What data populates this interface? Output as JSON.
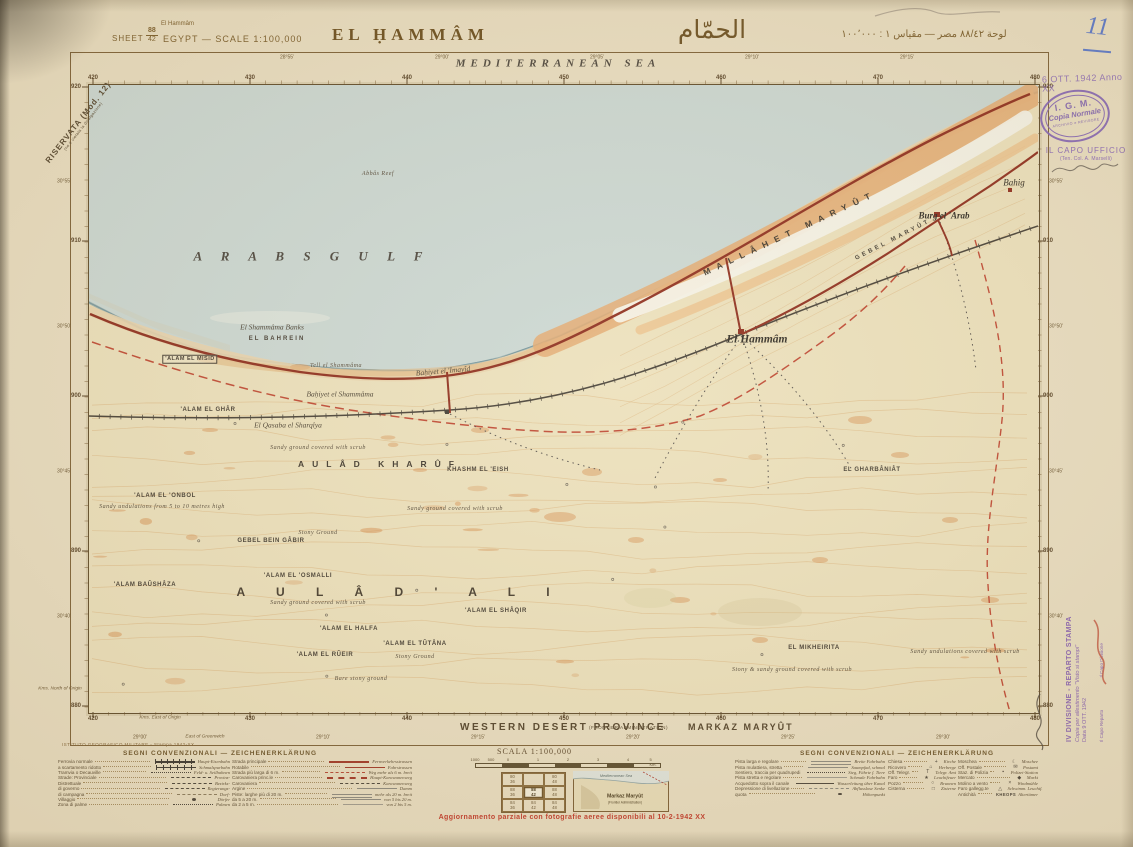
{
  "header": {
    "restricted": "RISERVATA (Mod. 12)",
    "restricted_sub": "(ne è vietata la divulgazione)",
    "sheet_label": "SHEET",
    "sheet_num_top": "88",
    "sheet_num_bottom": "42",
    "place_small": "El Hammâm",
    "country_scale": "EGYPT — SCALE 1:100,000",
    "title": "EL ḤAMMÂM",
    "title_arabic": "الحمّام",
    "arabic_scale": "لوحة ٨٨/٤٢   مصر — مقياس ١ : ١٠٠٬٠٠٠",
    "handwritten_number": "11",
    "date_stamp": "6 OTT. 1942 Anno XX"
  },
  "stamps": {
    "igm_line1": "I. G. M.",
    "igm_line2": "Copia Normale",
    "igm_line3": "ARCHIVIO e REVISORE",
    "capo_line1": "IL CAPO UFFICIO",
    "capo_line2": "(Ten. Col. A. Marselli)",
    "side_line1": "IV DIVISIONE - REPARTO STAMPA",
    "side_line2": "Copia per allestimento \"Visto si stampi\"",
    "side_line3": "Data  9 OTT. 1942",
    "side_line4": "Il Capo Reparto",
    "side_line5": "Il Capo Divisione"
  },
  "map": {
    "labels": [
      {
        "t": "MEDITERRANEAN  SEA",
        "x": 558,
        "y": 64,
        "c": "sea",
        "ls": 5
      },
      {
        "t": "A R A B S      G U L F",
        "x": 312,
        "y": 256,
        "c": "gulf",
        "ls": 8
      },
      {
        "t": "Abbâs Reef",
        "x": 378,
        "y": 174,
        "c": "nxx"
      },
      {
        "t": "El Shammâma Banks",
        "x": 272,
        "y": 327,
        "c": "nit"
      },
      {
        "t": "EL BAHREIN",
        "x": 277,
        "y": 339,
        "c": "cxs",
        "ls": 2
      },
      {
        "t": "'ALAM EL MISID",
        "x": 190,
        "y": 359,
        "c": "cbox"
      },
      {
        "t": "Tell el Shammâma",
        "x": 336,
        "y": 366,
        "c": "nxx"
      },
      {
        "t": "Baḥiyet el 'Imayîd",
        "x": 443,
        "y": 371,
        "c": "nit",
        "r": -5
      },
      {
        "t": "Baḥiyet el Shammâma",
        "x": 340,
        "y": 394,
        "c": "nit"
      },
      {
        "t": "'ALAM EL GHÂR",
        "x": 208,
        "y": 410,
        "c": "cxs"
      },
      {
        "t": "El Qasaba el Sharqîya",
        "x": 288,
        "y": 425,
        "c": "nit"
      },
      {
        "t": "Sandy ground covered with scrub",
        "x": 318,
        "y": 448,
        "c": "nxx"
      },
      {
        "t": "AULÂD  KHARÛF",
        "x": 380,
        "y": 464,
        "c": "cmd",
        "ls": 8
      },
      {
        "t": "KHASHM EL 'EISH",
        "x": 478,
        "y": 470,
        "c": "cxs"
      },
      {
        "t": "'ALAM EL 'ONBOL",
        "x": 165,
        "y": 496,
        "c": "cxs"
      },
      {
        "t": "Sandy undulations from 5 to 10 metres high",
        "x": 162,
        "y": 507,
        "c": "nxx"
      },
      {
        "t": "Sandy ground covered with scrub",
        "x": 455,
        "y": 509,
        "c": "nxx"
      },
      {
        "t": "Stony Ground",
        "x": 318,
        "y": 533,
        "c": "nxx"
      },
      {
        "t": "GEBEL BEIN GÂBIR",
        "x": 271,
        "y": 541,
        "c": "cxs"
      },
      {
        "t": "'ALAM EL 'OSMALLI",
        "x": 298,
        "y": 576,
        "c": "cxs"
      },
      {
        "t": "'ALAM BAÛSHÂZA",
        "x": 145,
        "y": 585,
        "c": "cxs"
      },
      {
        "t": "A U L Â D    ' A L I",
        "x": 400,
        "y": 592,
        "c": "clg",
        "ls": 14
      },
      {
        "t": "Sandy ground covered with scrub",
        "x": 318,
        "y": 603,
        "c": "nxx"
      },
      {
        "t": "'ALAM EL SHÂQIR",
        "x": 496,
        "y": 611,
        "c": "cxs"
      },
      {
        "t": "'ALAM EL HALFA",
        "x": 349,
        "y": 629,
        "c": "cxs"
      },
      {
        "t": "'ALAM EL TÛTÂNA",
        "x": 415,
        "y": 644,
        "c": "cxs"
      },
      {
        "t": "'ALAM EL RÛEIR",
        "x": 325,
        "y": 655,
        "c": "cxs"
      },
      {
        "t": "Stony Ground",
        "x": 415,
        "y": 657,
        "c": "nxx"
      },
      {
        "t": "Bare stony ground",
        "x": 361,
        "y": 679,
        "c": "nxx"
      },
      {
        "t": "EL MIKHEIRITA",
        "x": 814,
        "y": 648,
        "c": "cxs"
      },
      {
        "t": "Stony & sandy ground covered with scrub",
        "x": 792,
        "y": 670,
        "c": "nxx"
      },
      {
        "t": "Sandy undulations covered with scrub",
        "x": 965,
        "y": 652,
        "c": "nxx"
      },
      {
        "t": "El Ḥammâm",
        "x": 757,
        "y": 340,
        "c": "town"
      },
      {
        "t": "MALLÂHET  MARYÛT",
        "x": 790,
        "y": 233,
        "c": "cmd",
        "ls": 7,
        "r": -25
      },
      {
        "t": "GEBEL MARYÛT",
        "x": 893,
        "y": 240,
        "c": "cxs",
        "ls": 3,
        "r": -27
      },
      {
        "t": "Burg el 'Arab",
        "x": 944,
        "y": 216,
        "c": "tsm"
      },
      {
        "t": "Bahig",
        "x": 1014,
        "y": 183,
        "c": "tit"
      },
      {
        "t": "EL GHARBÂNIÂT",
        "x": 872,
        "y": 470,
        "c": "cxs"
      }
    ],
    "grid": {
      "eastings": [
        {
          "t": "420",
          "x": 93
        },
        {
          "t": "430",
          "x": 250
        },
        {
          "t": "440",
          "x": 407
        },
        {
          "t": "450",
          "x": 564
        },
        {
          "t": "460",
          "x": 721
        },
        {
          "t": "470",
          "x": 878
        },
        {
          "t": "480",
          "x": 1035
        }
      ],
      "northings": [
        {
          "t": "920",
          "y": 87
        },
        {
          "t": "910",
          "y": 241
        },
        {
          "t": "900",
          "y": 396
        },
        {
          "t": "890",
          "y": 551
        },
        {
          "t": "880",
          "y": 706
        }
      ],
      "top_longitudes": [
        {
          "t": "28°55′",
          "x": 287
        },
        {
          "t": "29°00′",
          "x": 442
        },
        {
          "t": "29°05′",
          "x": 597
        },
        {
          "t": "29°10′",
          "x": 752
        },
        {
          "t": "29°15′",
          "x": 907
        }
      ],
      "bottom_longitudes": [
        {
          "t": "29°00′",
          "x": 140
        },
        {
          "t": "29°10′",
          "x": 323
        },
        {
          "t": "29°15′",
          "x": 478
        },
        {
          "t": "29°20′",
          "x": 633
        },
        {
          "t": "29°25′",
          "x": 788
        },
        {
          "t": "29°30′",
          "x": 943
        }
      ],
      "latitudes": [
        {
          "t": "30°55′",
          "y": 182
        },
        {
          "t": "30°50′",
          "y": 327
        },
        {
          "t": "30°45′",
          "y": 472
        },
        {
          "t": "30°40′",
          "y": 617
        }
      ],
      "greenwich": "East of Greenwich",
      "origin_north": "Kms. North of Origin",
      "origin_east": "Kms. East of Origin"
    }
  },
  "footer": {
    "province": "WESTERN  DESERT  PROVINCE",
    "province_sub": "(FRONTIER ADMINISTRATION)",
    "markaz": "MARKAZ  MARYÛT",
    "imprint": "ISTITUTO GEOGRAFICO MILITARE - Stampa 1942-XX",
    "scale_caption": "SCALA  1:100,000",
    "scale_numbers": [
      "1000",
      "500",
      "0",
      "1",
      "2",
      "3",
      "4",
      "5 Km."
    ],
    "update_note": "Aggiornamento parziale con fotografie aeree disponibili al 10-2-1942 XX",
    "inset": {
      "sea": "Mediterranean Sea",
      "name": "Markaz Maryût",
      "sub": "(Frontier Administration)"
    },
    "index_grid": [
      [
        "80/36",
        "",
        "80/48"
      ],
      [
        "88/36",
        "88/42",
        "88/48"
      ],
      [
        "84/36",
        "84/42",
        "84/48"
      ]
    ]
  },
  "legend_left": {
    "heading": "SEGNI CONVENZIONALI — ZEICHENERKLÄRUNG",
    "colA": [
      {
        "it": "Ferrovia normale",
        "s": "rail",
        "de": "Haupt-Eisenbahn"
      },
      {
        "it": "a scartamento ridotto",
        "s": "rail2",
        "de": "Schmalspurbahn"
      },
      {
        "it": "Tramvia o Decauville",
        "s": "dots",
        "de": "Feld- u. Seilbahnen"
      },
      {
        "it": "Strade: Provinciale",
        "s": "dashdot",
        "de": "Provinz-"
      },
      {
        "it": "Distrettuale",
        "s": "dash",
        "de": "Bezirks-"
      },
      {
        "it": "di governo",
        "s": "dash",
        "de": "Regierungs-"
      },
      {
        "it": "di campagna",
        "s": "dash2",
        "de": "Dorf-"
      },
      {
        "it": "Villaggio",
        "s": "dot",
        "de": "Dörfer"
      },
      {
        "it": "Zona di palme",
        "s": "dotline",
        "de": "Palmen"
      }
    ],
    "colB": [
      {
        "it": "Strada principale",
        "s": "redbold",
        "de": "Fernverkehrsstrassen"
      },
      {
        "it": "Rotabile",
        "s": "red",
        "de": "Fahrstrassen"
      },
      {
        "it": "Strada più larga di 6 m.",
        "s": "reddash",
        "de": "Weg mehr als 6 m. breit"
      },
      {
        "it": "Carovaniera princ.le",
        "s": "reddashbold",
        "de": "Haupt-Karawanenweg"
      },
      {
        "it": "Carovaniera",
        "s": "dash",
        "de": "Karawanenweg"
      },
      {
        "it": "Argine",
        "s": "gray",
        "de": "Damm"
      },
      {
        "it": "Piste: larghe più di 20 m.",
        "s": "gray2",
        "de": "mehr als 20 m. breit"
      },
      {
        "it": "da 5 a 20 m.",
        "s": "gray",
        "de": "von 5 bis 20 m."
      },
      {
        "it": "da 2 a 5 m.",
        "s": "graythin",
        "de": "von 2 bis 5 m."
      }
    ]
  },
  "legend_right": {
    "heading": "SEGNI CONVENZIONALI — ZEICHENERKLÄRUNG",
    "groupA": [
      {
        "it": "Pista larga e regolare",
        "s": "gray2",
        "de": "Breite Fahrbahn"
      },
      {
        "it": "Pista mulattiera, stretta",
        "s": "gray",
        "de": "Saumpfad, schmal"
      },
      {
        "it": "Sentiero, traccia per quadrupedi",
        "s": "dotline",
        "de": "Steg, Fährte f. Tiere"
      },
      {
        "it": "Pista stretta e regolare",
        "s": "graythin",
        "de": "Schmale Fahrbahn"
      },
      {
        "it": "Acquedotto sopra il canale",
        "s": "aqua",
        "de": "Wasserleitung über Kanal"
      },
      {
        "it": "Depressione di livellazione",
        "s": "depr",
        "de": "Abflusslose Senke"
      },
      {
        "it": "quota",
        "s": "quota",
        "de": "Höhenpunkt"
      }
    ],
    "groupB": [
      {
        "it": "Chiesa",
        "g": "+",
        "de": "Kirche"
      },
      {
        "it": "Ricovero",
        "g": "⌂",
        "de": "Herberge"
      },
      {
        "it": "Off. Telegr.",
        "g": "T",
        "de": "Telegr. Amt"
      },
      {
        "it": "Faro",
        "g": "★",
        "de": "Leuchtfeuer"
      },
      {
        "it": "Pozzo",
        "g": "○",
        "de": "Brunnen"
      },
      {
        "it": "Cisterna",
        "g": "□",
        "de": "Zisterne"
      }
    ],
    "groupC": [
      {
        "it": "Moschea",
        "g": "☾",
        "de": "Moschee"
      },
      {
        "it": "Off. Postale",
        "g": "✉",
        "de": "Postamt"
      },
      {
        "it": "Staz. di Polizia",
        "g": "▪",
        "de": "Polizei-Station"
      },
      {
        "it": "Mercato",
        "g": "◆",
        "de": "Markt"
      },
      {
        "it": "Molino a vento",
        "g": "×",
        "de": "Windmühle"
      },
      {
        "it": "Faro gallegg.te",
        "g": "△",
        "de": "Schwimm. Leuchtf."
      },
      {
        "it": "Antichità",
        "g": "KHEOPS",
        "de": "Altertümer"
      }
    ]
  }
}
